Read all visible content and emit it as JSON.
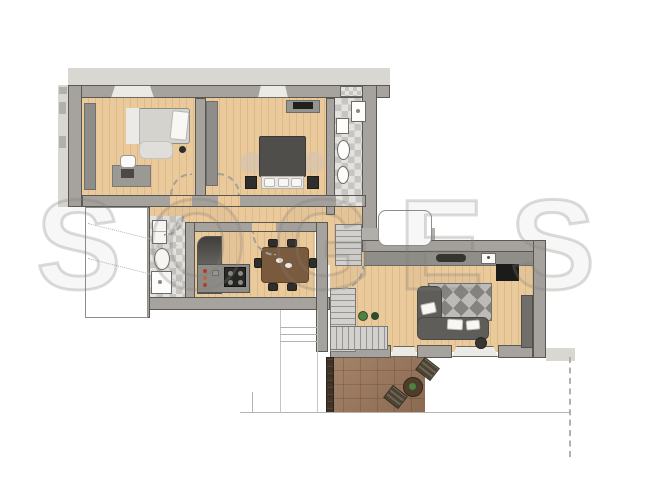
{
  "watermark": {
    "text": "SOGES"
  },
  "palette": {
    "wall": "#a6a39e",
    "wallEdge": "#5a5853",
    "wallLight": "#d9d7d2",
    "woodA": "#eac99b",
    "woodB": "#deb98b",
    "tileA": "#c6c5c2",
    "tileB": "#e3e2df",
    "stairA": "#d2d1cd",
    "stairB": "#969490",
    "rugGeoA": "#84837f",
    "rugGeoB": "#bcbbb7",
    "terrA": "#a5846a",
    "terrB": "#8b6a52",
    "hedge": "#3b3227",
    "green": "#4c8342",
    "counter": "#8f8e89",
    "counterDark": "#4b4a46",
    "sofa": "#5e5d59",
    "furnDark": "#2e2e2c",
    "rugBeige": "rgba(208,197,180,0.6)",
    "arc": "#a3a19c",
    "line": "#b5b3ae",
    "watermark": "rgba(128,125,118,0.28)"
  }
}
